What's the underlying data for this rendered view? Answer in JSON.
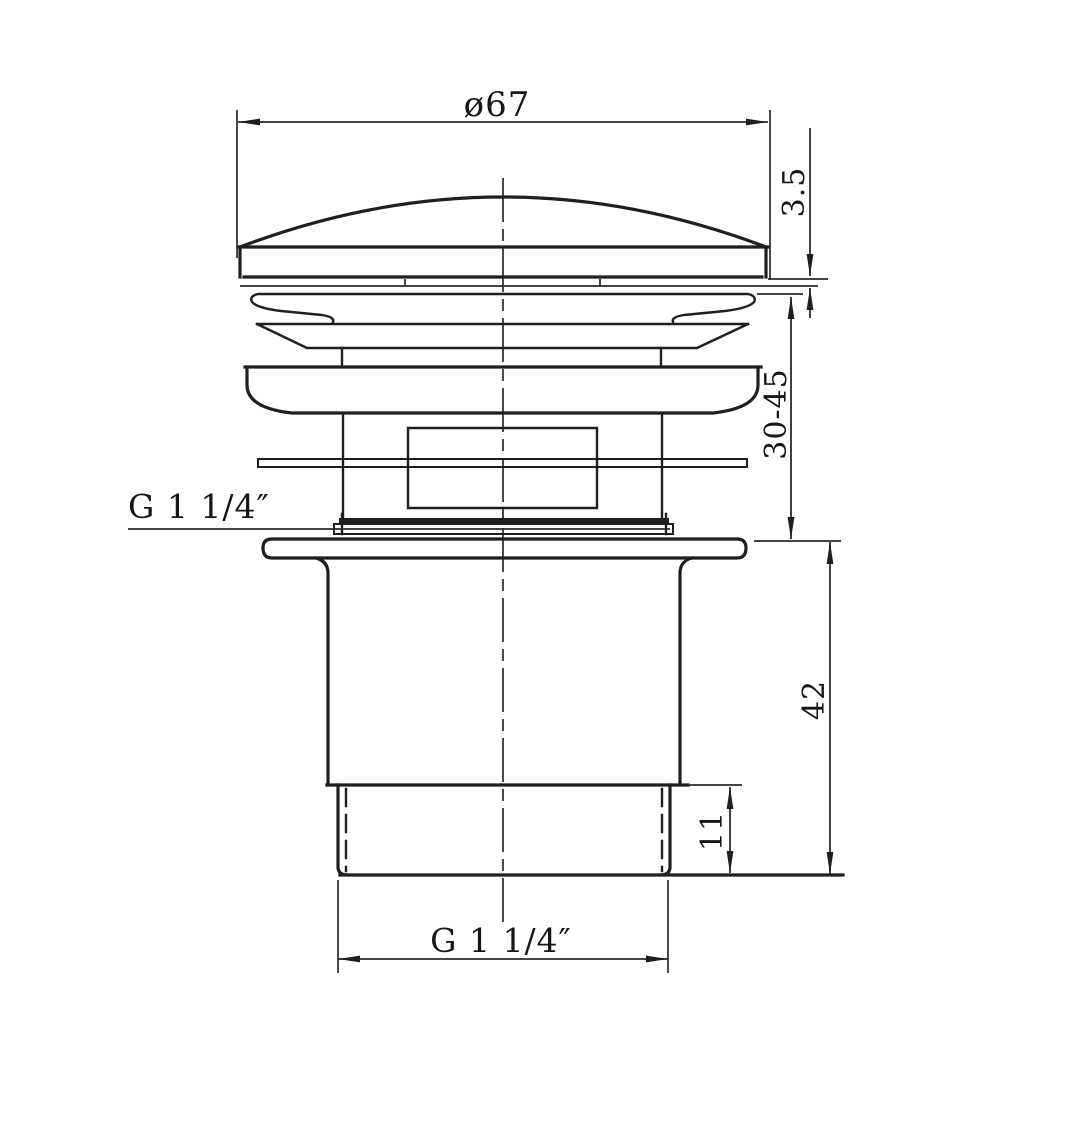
{
  "labels": {
    "cap_diameter": "ø67",
    "cap_edge_thickness": "3.5",
    "adjustable_height_range": "30-45",
    "thread_spec_side": "G 1 1/4″",
    "tailpiece_length": "42",
    "thread_length": "11",
    "thread_spec_bottom": "G 1 1/4″"
  },
  "colors": {
    "line": "#1f1f1f",
    "dim_line": "#2a2a2a",
    "text": "#161616",
    "background": "#ffffff"
  }
}
